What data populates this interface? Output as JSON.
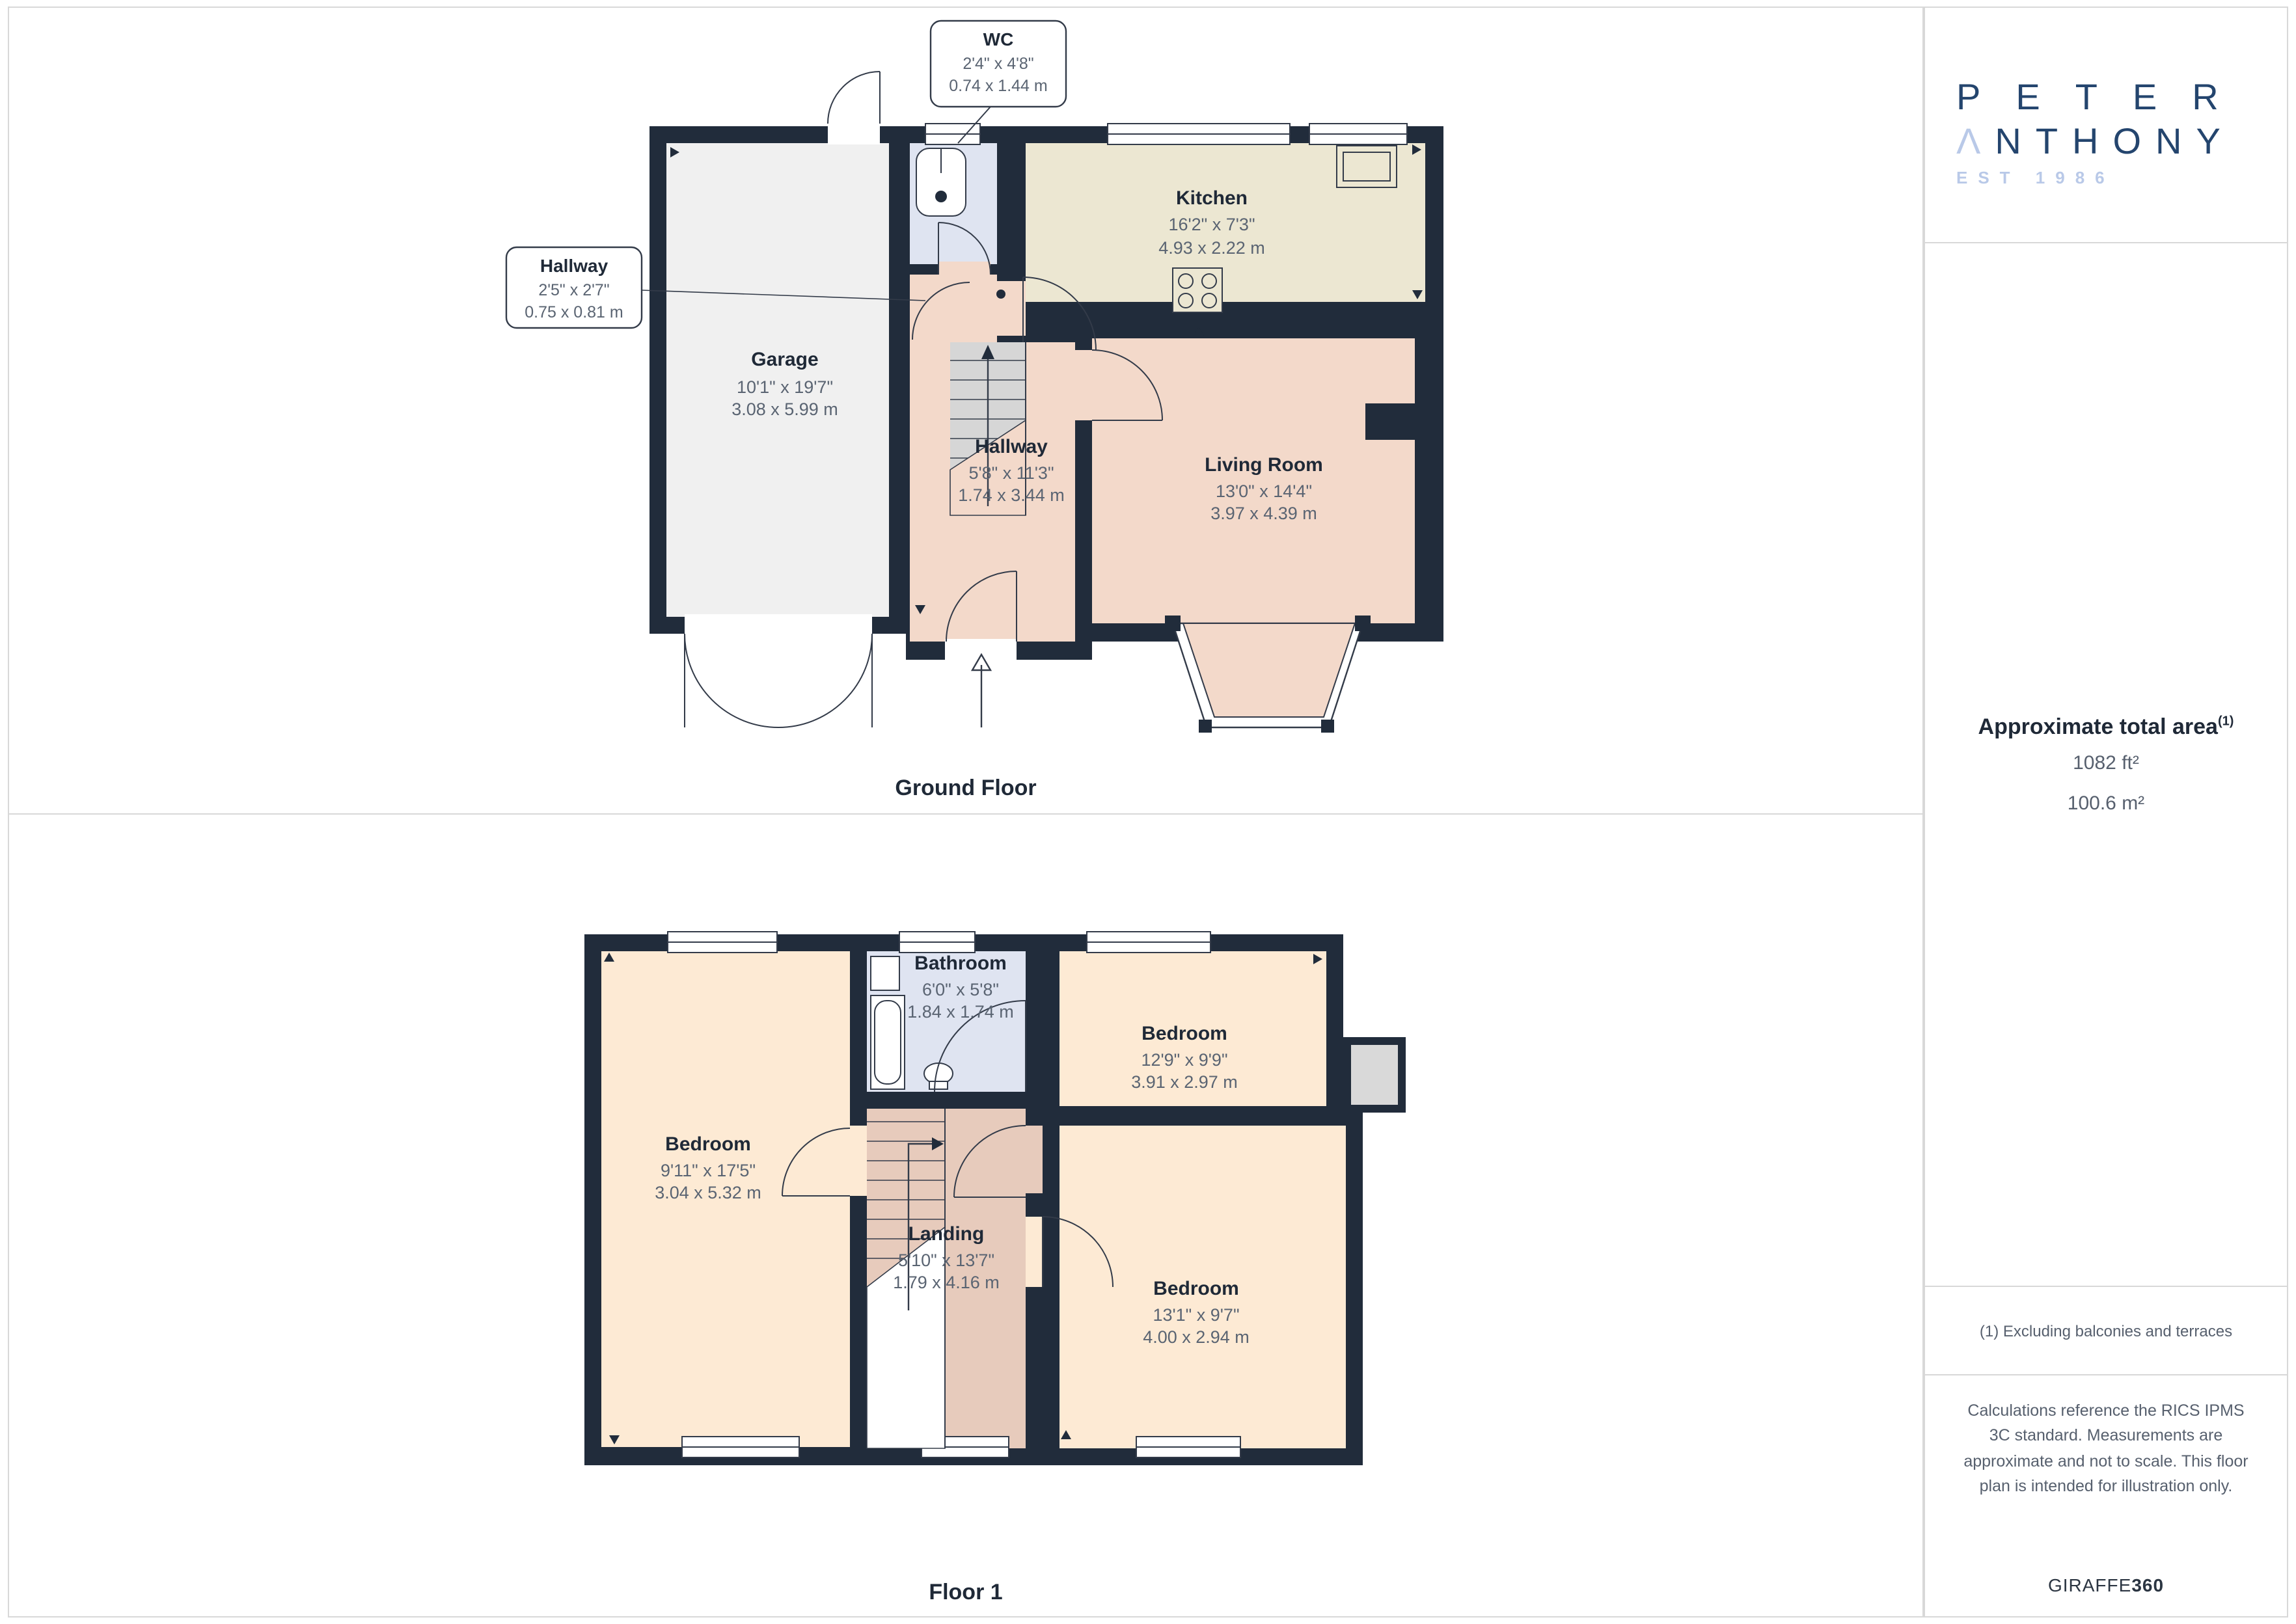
{
  "colors": {
    "wall": "#212c3b",
    "garage_fill": "#f0f0f0",
    "kitchen_fill": "#ece7d2",
    "living_fill": "#f3d9ca",
    "bath_fill": "#dfe4f1",
    "bedroom_fill": "#fdead4",
    "landing_fill": "#e7cbbc",
    "closet_fill": "#d9d9d9",
    "border": "#d8d8d8",
    "text_primary": "#1f2937",
    "text_secondary": "#57606e",
    "logo_navy": "#24456e",
    "logo_light": "#b9c9e8"
  },
  "sidebar": {
    "logo": {
      "line1": "PETER",
      "a": "Λ",
      "line2_rest": "NTHONY",
      "line3": "EST 1986"
    },
    "area": {
      "title": "Approximate total area",
      "marker": "(1)",
      "imperial": "1082 ft²",
      "metric": "100.6 m²"
    },
    "footnote": "(1) Excluding balconies and terraces",
    "disclaimer": "Calculations reference the RICS IPMS 3C standard. Measurements are approximate and not to scale. This floor plan is intended for illustration only.",
    "brand": {
      "name": "GIRAFFE",
      "suffix": "360"
    }
  },
  "ground": {
    "caption": "Ground Floor",
    "wc": {
      "name": "WC",
      "imperial": "2'4\" x 4'8\"",
      "metric": "0.74 x 1.44 m"
    },
    "hallway_small": {
      "name": "Hallway",
      "imperial": "2'5\" x 2'7\"",
      "metric": "0.75 x 0.81 m"
    },
    "garage": {
      "name": "Garage",
      "imperial": "10'1\" x 19'7\"",
      "metric": "3.08 x 5.99 m"
    },
    "kitchen": {
      "name": "Kitchen",
      "imperial": "16'2\" x 7'3\"",
      "metric": "4.93 x 2.22 m"
    },
    "hallway": {
      "name": "Hallway",
      "imperial": "5'8\" x 11'3\"",
      "metric": "1.74 x 3.44 m"
    },
    "living": {
      "name": "Living Room",
      "imperial": "13'0\" x 14'4\"",
      "metric": "3.97 x 4.39 m"
    }
  },
  "floor1": {
    "caption": "Floor 1",
    "bedroom_left": {
      "name": "Bedroom",
      "imperial": "9'11\" x 17'5\"",
      "metric": "3.04 x 5.32 m"
    },
    "bathroom": {
      "name": "Bathroom",
      "imperial": "6'0\" x 5'8\"",
      "metric": "1.84 x 1.74 m"
    },
    "bedroom_top": {
      "name": "Bedroom",
      "imperial": "12'9\" x 9'9\"",
      "metric": "3.91 x 2.97 m"
    },
    "landing": {
      "name": "Landing",
      "imperial": "5'10\" x 13'7\"",
      "metric": "1.79 x 4.16 m"
    },
    "bedroom_bottom": {
      "name": "Bedroom",
      "imperial": "13'1\" x 9'7\"",
      "metric": "4.00 x 2.94 m"
    }
  }
}
